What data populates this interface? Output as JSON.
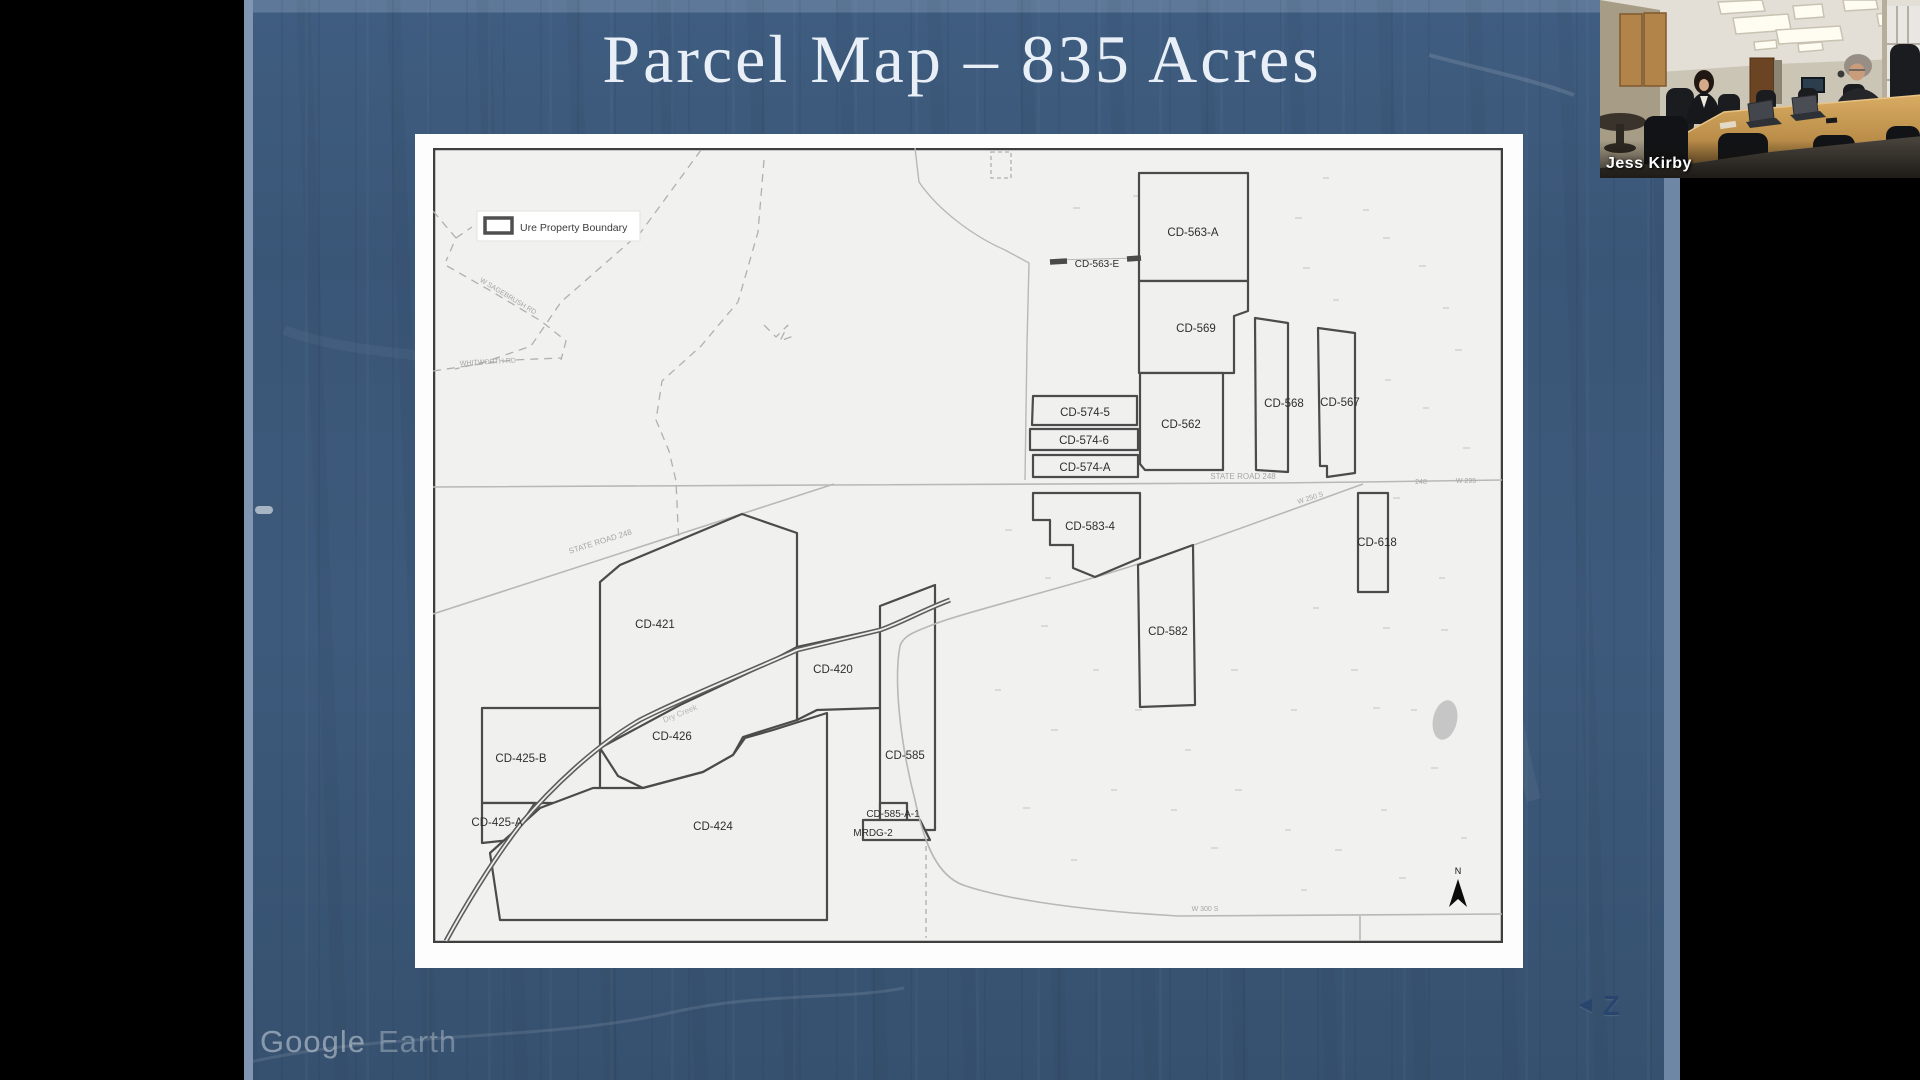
{
  "slide": {
    "title": "Parcel Map – 835 Acres"
  },
  "map": {
    "legend": {
      "label": "Ure Property Boundary"
    },
    "north": {
      "label": "N"
    },
    "parcels": [
      {
        "label": "CD-563-A",
        "x": 760,
        "y": 88
      },
      {
        "label": "CD-563-E",
        "x": 664,
        "y": 119
      },
      {
        "label": "CD-569",
        "x": 763,
        "y": 184
      },
      {
        "label": "CD-562",
        "x": 748,
        "y": 280
      },
      {
        "label": "CD-568",
        "x": 851,
        "y": 259
      },
      {
        "label": "CD-567",
        "x": 907,
        "y": 258
      },
      {
        "label": "CD-574-5",
        "x": 652,
        "y": 268
      },
      {
        "label": "CD-574-6",
        "x": 651,
        "y": 296
      },
      {
        "label": "CD-574-A",
        "x": 652,
        "y": 323
      },
      {
        "label": "CD-583-4",
        "x": 657,
        "y": 382
      },
      {
        "label": "CD-582",
        "x": 735,
        "y": 487
      },
      {
        "label": "CD-618",
        "x": 944,
        "y": 398
      },
      {
        "label": "CD-421",
        "x": 222,
        "y": 480
      },
      {
        "label": "CD-420",
        "x": 400,
        "y": 525
      },
      {
        "label": "CD-426",
        "x": 239,
        "y": 592
      },
      {
        "label": "CD-425-B",
        "x": 88,
        "y": 614
      },
      {
        "label": "CD-425-A",
        "x": 64,
        "y": 678
      },
      {
        "label": "CD-424",
        "x": 280,
        "y": 682
      },
      {
        "label": "CD-585",
        "x": 472,
        "y": 611
      },
      {
        "label": "CD-585-A-1",
        "x": 460,
        "y": 669
      },
      {
        "label": "MRDG-2",
        "x": 440,
        "y": 688
      }
    ],
    "road_labels": [
      {
        "label": "STATE ROAD 248"
      },
      {
        "label": "STATE ROAD 248"
      },
      {
        "label": "248"
      },
      {
        "label": "W 295"
      },
      {
        "label": "W 250 S"
      },
      {
        "label": "W 300 S"
      },
      {
        "label": "Dry Creek"
      },
      {
        "label": "W SAGEBRUSH RD"
      },
      {
        "label": "WHITWORTH RD"
      }
    ]
  },
  "webcam": {
    "name": "Jess Kirby"
  },
  "watermarks": {
    "google": "Google",
    "earth": "Earth",
    "zoom_arrow": "◄",
    "zoom_letter": "Z"
  },
  "colors": {
    "background": "#000000",
    "earth_blue": "#3d5a7c",
    "accent_strip": "#8196b2",
    "page": "#fdfdfd",
    "map_bg": "#f1f1f0",
    "parcel_line": "#4b4b4b",
    "title_text": "#e9eff7"
  }
}
